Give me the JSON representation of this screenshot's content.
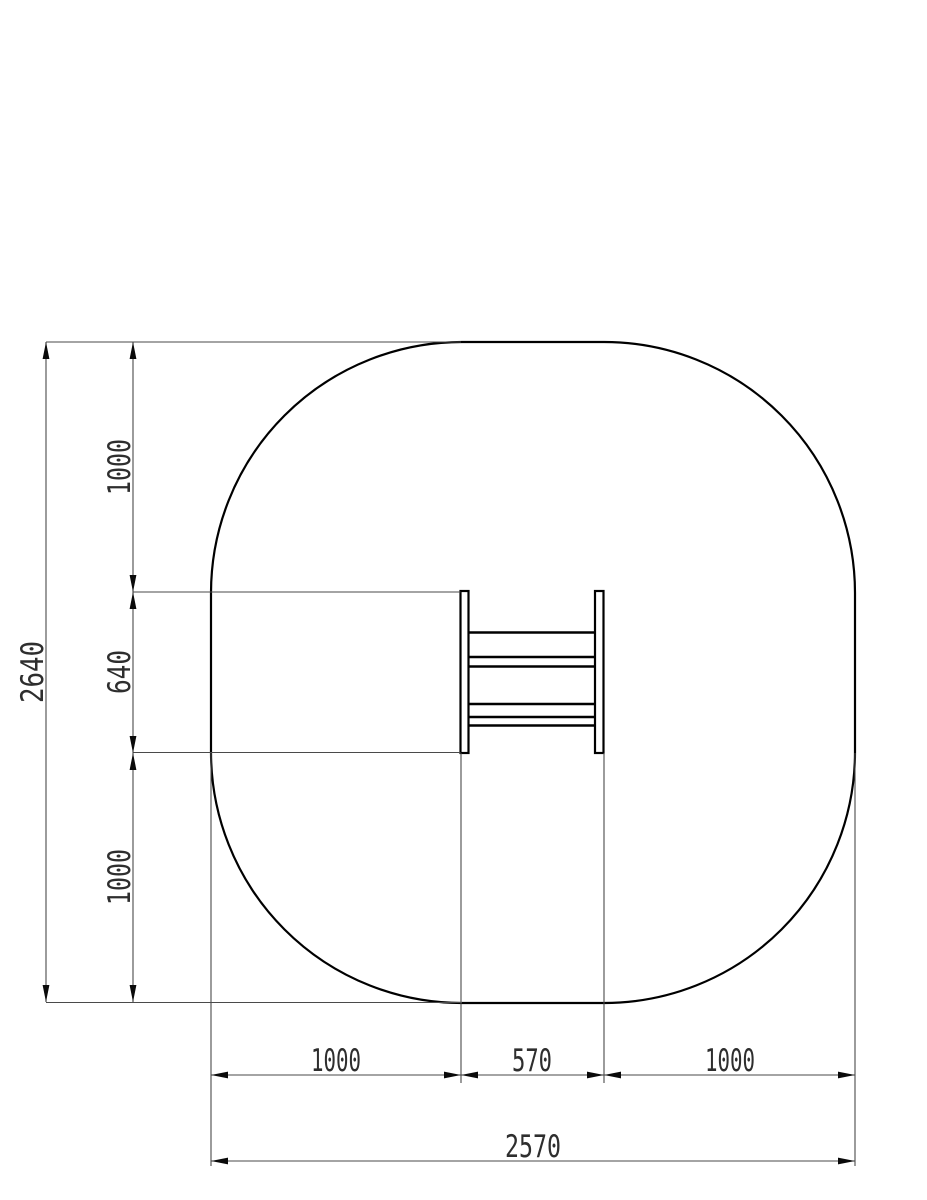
{
  "drawing": {
    "kind": "plan-view clearance / safety zone drawing",
    "colors": {
      "object_line": "#000000",
      "dimension_line": "#4a4a4a",
      "arrow": "#0a0a0a",
      "background": "#ffffff",
      "text": "#2e2e2e"
    },
    "dims": {
      "overall_height": "2640",
      "clearance_top": "1000",
      "equipment_depth": "640",
      "clearance_bottom": "1000",
      "clearance_left": "1000",
      "equipment_width": "570",
      "clearance_right": "1000",
      "overall_width": "2570"
    }
  }
}
